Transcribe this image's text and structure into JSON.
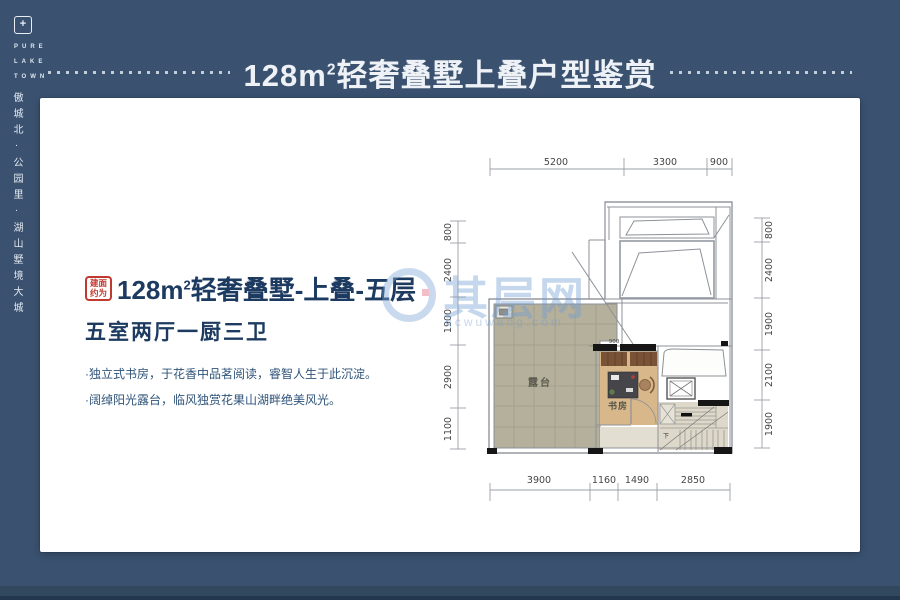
{
  "banner": {
    "prefix": "128m",
    "sup": "2",
    "suffix": "轻奢叠墅上叠户型鉴赏"
  },
  "sidebar": {
    "logo_symbol": "+",
    "logo_lines": [
      "PURE",
      "LAKE",
      "TOWN"
    ],
    "slogan": "傲城北·公园里·湖山墅境大城"
  },
  "info": {
    "badge": [
      "建面",
      "约为"
    ],
    "title_prefix": "128m",
    "title_sup": "2",
    "title_suffix": "轻奢叠墅-上叠-五层",
    "subtitle": "五室两厅一厨三卫",
    "bullets": [
      "·独立式书房，于花香中品茗阅读，睿智人生于此沉淀。",
      "·阔绰阳光露台，临风独赏花果山湖畔绝美风光。"
    ]
  },
  "watermark": {
    "name": "其层网",
    "domain": "qcwuwang.com"
  },
  "floorplan": {
    "dims_top": [
      "5200",
      "3300",
      "900"
    ],
    "dims_bottom": [
      "3900",
      "1160",
      "1490",
      "2850"
    ],
    "dims_left": [
      "800",
      "2400",
      "1900",
      "2900",
      "1100"
    ],
    "dims_right": [
      "800",
      "2400",
      "1900",
      "2100",
      "1900"
    ],
    "opening_dim": "900",
    "rooms": {
      "terrace": "露台",
      "study": "书房"
    },
    "stairs_down": "下"
  },
  "colors": {
    "background": "#3a5270",
    "heading_navy": "#1d3b61",
    "badge_red": "#c0392f",
    "watermark_blue": "#7da4d7",
    "terrace_tile": "#b4b09b",
    "study_wood": "#d8b78a"
  }
}
